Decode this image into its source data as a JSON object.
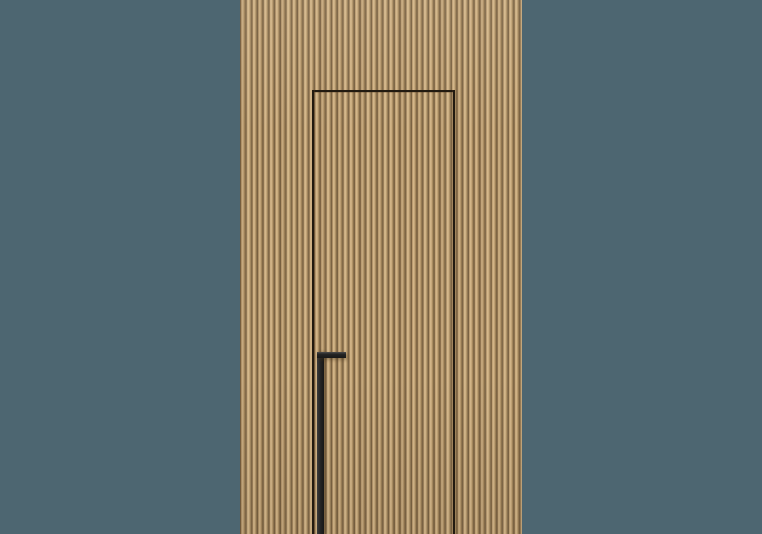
{
  "meta": {
    "description": "3D render of a concealed flush interior door with an integrated matte-black pull handle, set into a vertical fluted oak wood-slat wall panel, centered on a plain slate blue-grey backdrop",
    "image_width_px": 762,
    "image_height_px": 534,
    "visible_text": "none"
  },
  "colors": {
    "background": "#4d6671",
    "wood_light": "#cbad80",
    "wood_face": "#c4a577",
    "wood_mid": "#b29367",
    "wood_groove": "#7a6242",
    "wood_highlight": "#d6b98c",
    "door_gap_line": "#221a10",
    "handle_black": "#252525",
    "handle_highlight": "#4e4e4e"
  },
  "elements": {
    "backdrop_wall": {
      "shape": "full-frame background",
      "color": "#4d6671"
    },
    "fluted_wood_panel": {
      "left_px": 240,
      "width_px": 282,
      "height_px": 534,
      "slat_pitch_px": 5.7,
      "slat_orientation": "vertical"
    },
    "door_gap_outline": {
      "line_color": "#221a10",
      "line_width_px": 2,
      "top_y_px": 90,
      "left_x_px": 312,
      "right_x_px": 453,
      "extends_to_bottom_edge": true
    },
    "door_handle": {
      "style": "inverted-L black profile pull",
      "top_bar": {
        "x_px": 317,
        "y_px": 352,
        "width_px": 28.5,
        "height_px": 5.5
      },
      "stem": {
        "x_px": 317,
        "y_px": 352,
        "width_px": 6.5,
        "extends_to_bottom_edge": true
      }
    }
  }
}
